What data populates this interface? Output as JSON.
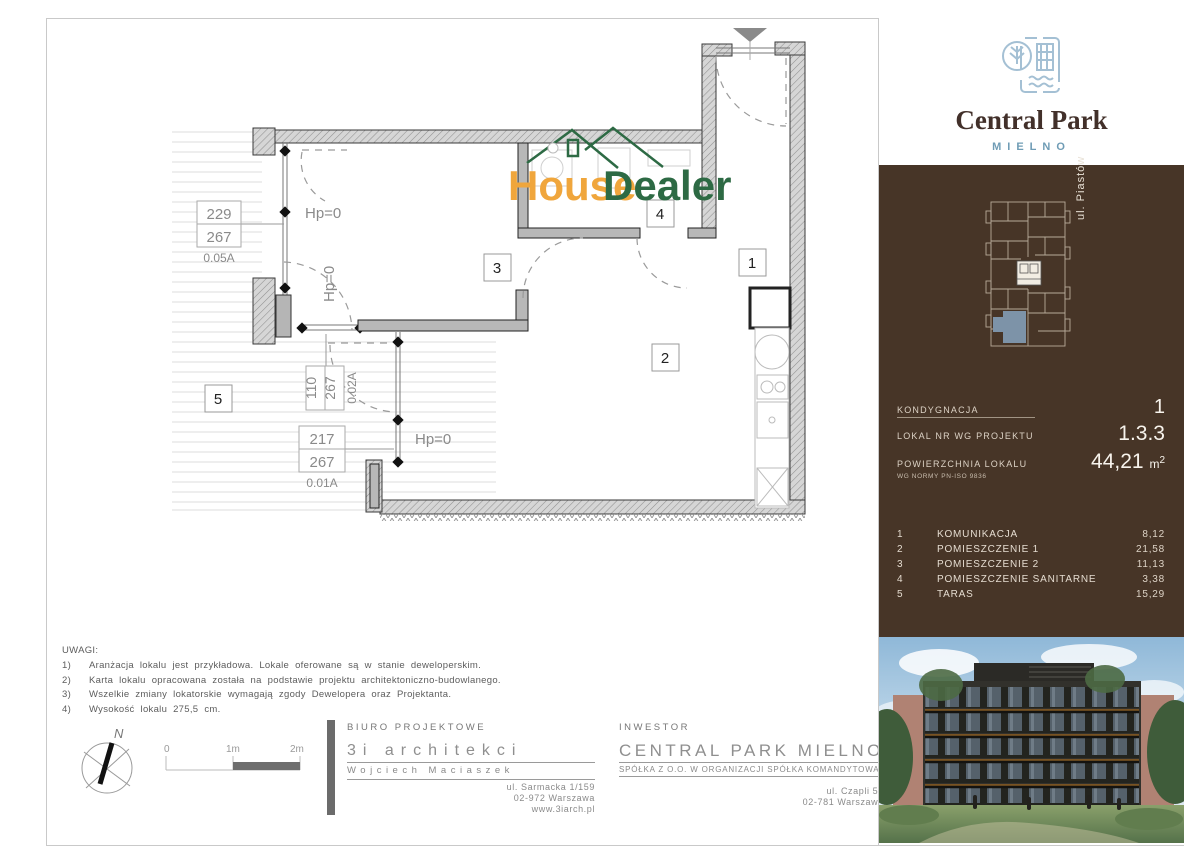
{
  "brand": {
    "name": "Central Park",
    "city": "MIELNO"
  },
  "watermark": {
    "word1": "House",
    "word2": "Dealer"
  },
  "sidebar": {
    "street": "ul. Piastów",
    "info": {
      "floor_label": "KONDYGNACJA",
      "floor_value": "1",
      "unit_label": "LOKAL NR WG PROJEKTU",
      "unit_value": "1.3.3",
      "area_label": "POWIERZCHNIA LOKALU",
      "area_norm": "WG NORMY PN-ISO 9836",
      "area_value": "44,21",
      "area_unit": "m",
      "area_sup": "2"
    },
    "rooms": [
      {
        "no": "1",
        "name": "KOMUNIKACJA",
        "area": "8,12"
      },
      {
        "no": "2",
        "name": "POMIESZCZENIE 1",
        "area": "21,58"
      },
      {
        "no": "3",
        "name": "POMIESZCZENIE 2",
        "area": "11,13"
      },
      {
        "no": "4",
        "name": "POMIESZCZENIE SANITARNE",
        "area": "3,38"
      },
      {
        "no": "5",
        "name": "TARAS",
        "area": "15,29"
      }
    ]
  },
  "plan": {
    "rooms": {
      "r1": "1",
      "r2": "2",
      "r3": "3",
      "r4": "4",
      "r5": "5"
    },
    "hp": "Hp=0",
    "dims": [
      {
        "a": "229",
        "b": "267",
        "code": "0.05A"
      },
      {
        "a": "110",
        "b": "267",
        "code": "0.02A"
      },
      {
        "a": "217",
        "b": "267",
        "code": "0.01A"
      }
    ]
  },
  "notes": {
    "title": "UWAGI:",
    "items": [
      {
        "no": "1)",
        "text": "Aranżacja lokalu jest przykładowa. Lokale oferowane są w stanie deweloperskim."
      },
      {
        "no": "2)",
        "text": "Karta lokalu opracowana została na podstawie projektu architektoniczno-budowlanego."
      },
      {
        "no": "3)",
        "text": "Wszelkie zmiany lokatorskie wymagają zgody Dewelopera oraz Projektanta."
      },
      {
        "no": "4)",
        "text": "Wysokość lokalu 275,5 cm."
      }
    ]
  },
  "compass": {
    "north": "N"
  },
  "scalebar": {
    "t0": "0",
    "t1": "1m",
    "t2": "2m"
  },
  "office": {
    "header": "BIURO PROJEKTOWE",
    "name": "3i architekci",
    "person": "Wojciech Maciaszek",
    "addr1": "ul. Sarmacka 1/159",
    "addr2": "02-972 Warszawa",
    "addr3": "www.3iarch.pl"
  },
  "investor": {
    "header": "INWESTOR",
    "name": "CENTRAL PARK MIELNO",
    "subname": "SPÓŁKA Z O.O. W ORGANIZACJI SPÓŁKA KOMANDYTOWA",
    "addr1": "ul. Czapli 57",
    "addr2": "02-781 Warszawa"
  },
  "colors": {
    "panel_brown": "#473527",
    "logo_blue": "#a4c0d4",
    "mielno_blue": "#6f9cb5",
    "watermark_orange": "#f0a63c",
    "watermark_green": "#2d6a44",
    "highlight_unit": "#7d93a8",
    "wall_gray": "#b8b8b8"
  }
}
